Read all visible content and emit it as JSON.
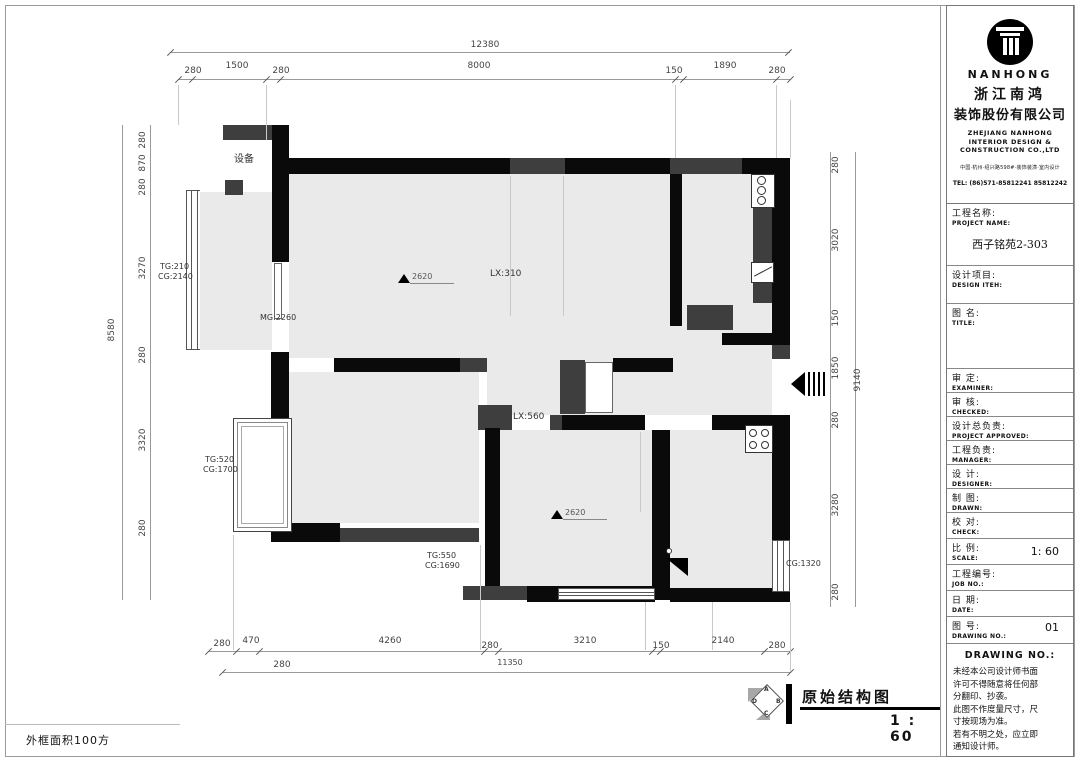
{
  "sheet": {
    "frame_area_label": "外框面积100方"
  },
  "colors": {
    "wall_black": "#0a0a0a",
    "wall_gray": "#3e3e3e",
    "floor": "#eaeaea",
    "dim_line": "#999999",
    "dim_text": "#444444"
  },
  "plan": {
    "labels": {
      "equipment": "设备",
      "tg1": "TG:210",
      "cg1": "CG:2140",
      "mg": "MG:2260",
      "lx1": "LX:310",
      "lx2": "LX:560",
      "tg2": "TG:520",
      "cg2": "CG:1700",
      "tg3": "TG:550",
      "cg3": "CG:1690",
      "cg4": "CG:1320",
      "level1": "2620",
      "level2": "2620"
    },
    "dims": {
      "top_overall": "12380",
      "top": [
        "280",
        "1500",
        "280",
        "8000",
        "150",
        "1890",
        "280"
      ],
      "left_overall": "8580",
      "left": [
        "280",
        "870",
        "280",
        "3270",
        "280",
        "3320",
        "280"
      ],
      "right_overall": "9140",
      "right": [
        "280",
        "3020",
        "150",
        "1850",
        "280",
        "3280",
        "280"
      ],
      "bottom": [
        "280",
        "470",
        "4260",
        "280",
        "3210",
        "150",
        "2140",
        "280"
      ],
      "bottom2": [
        "280",
        "11350"
      ]
    }
  },
  "footer": {
    "title": "原始结构图",
    "scale": "1 : 60",
    "marker": {
      "a": "A",
      "b": "B",
      "c": "C",
      "d": "D"
    }
  },
  "titleblock": {
    "company_en": "NANHONG",
    "company_zh1": "浙江南鸿",
    "company_zh2": "装饰股份有限公司",
    "sub1": "ZHEJIANG NANHONG",
    "sub2": "INTERIOR DESIGN &",
    "sub3": "CONSTRUCTION CO.,LTD",
    "address": "中国·杭州·绍兴路598#·装饰装潢·室内设计",
    "tel": "TEL: (86)571-85812241  85812242",
    "rows": [
      {
        "zh": "工程名称:",
        "en": "PROJECT NAME:",
        "value": "西子铭苑2-303"
      },
      {
        "zh": "设计项目:",
        "en": "DESIGN ITEH:",
        "value": ""
      },
      {
        "zh": "图  名:",
        "en": "TITLE:",
        "value": ""
      },
      {
        "zh": "审  定:",
        "en": "EXAMINER:",
        "value": ""
      },
      {
        "zh": "审  核:",
        "en": "CHECKED:",
        "value": ""
      },
      {
        "zh": "设计总负责:",
        "en": "PROJECT APPROVED:",
        "value": ""
      },
      {
        "zh": "工程负责:",
        "en": "MANAGER:",
        "value": ""
      },
      {
        "zh": "设  计:",
        "en": "DESIGNER:",
        "value": ""
      },
      {
        "zh": "制  图:",
        "en": "DRAWN:",
        "value": ""
      },
      {
        "zh": "校  对:",
        "en": "CHECK:",
        "value": ""
      },
      {
        "zh": "比  例:",
        "en": "SCALE:",
        "value": "1: 60"
      },
      {
        "zh": "工程编号:",
        "en": "JOB  NO.:",
        "value": ""
      },
      {
        "zh": "日  期:",
        "en": "DATE:",
        "value": ""
      },
      {
        "zh": "图  号:",
        "en": "DRAWING NO.:",
        "value": "01"
      }
    ],
    "footer_heading": "DRAWING NO.:",
    "notice": "未经本公司设计师书面\n许可不得随意将任何部\n分翻印、抄袭。\n此图不作度量尺寸，尺\n寸按现场为准。\n若有不明之处，应立即\n通知设计师。"
  }
}
